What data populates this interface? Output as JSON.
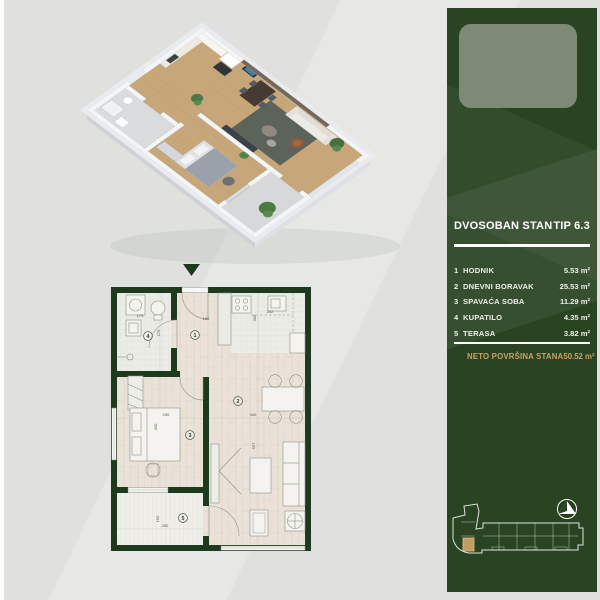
{
  "sidebar": {
    "title": "DVOSOBAN STAN",
    "type_label": "TIP 6.3",
    "rooms": [
      {
        "num": "1",
        "name": "HODNIK",
        "area": "5.53 m²"
      },
      {
        "num": "2",
        "name": "DNEVNI BORAVAK",
        "area": "25.53 m²"
      },
      {
        "num": "3",
        "name": "SPAVAĆA SOBA",
        "area": "11.29 m²"
      },
      {
        "num": "4",
        "name": "KUPATILO",
        "area": "4.35 m²"
      },
      {
        "num": "5",
        "name": "TERASA",
        "area": "3.82 m²"
      }
    ],
    "total_label": "NETO POVRŠINA STANA",
    "total_value": "50.52 m²",
    "colors": {
      "background": "#2a4423",
      "accent_gold": "#c9a265",
      "logo_placeholder": "#7d8a76"
    }
  },
  "floor_plan": {
    "room_labels": {
      "r1": "1",
      "r2": "2",
      "r3": "3",
      "r4": "4",
      "r5": "5"
    },
    "dimensions": {
      "bathroom_w": "170",
      "bathroom_h": "275",
      "hall_w": "186",
      "kitchen_h": "300",
      "kitchen_w": "242",
      "bedroom_w": "290",
      "bedroom_h": "430",
      "living_w": "340",
      "living_h": "557",
      "terrace_h": "150",
      "terrace_w": "250"
    },
    "wall_color": "#1d3a1c",
    "floor_color": "#eae2d8"
  }
}
